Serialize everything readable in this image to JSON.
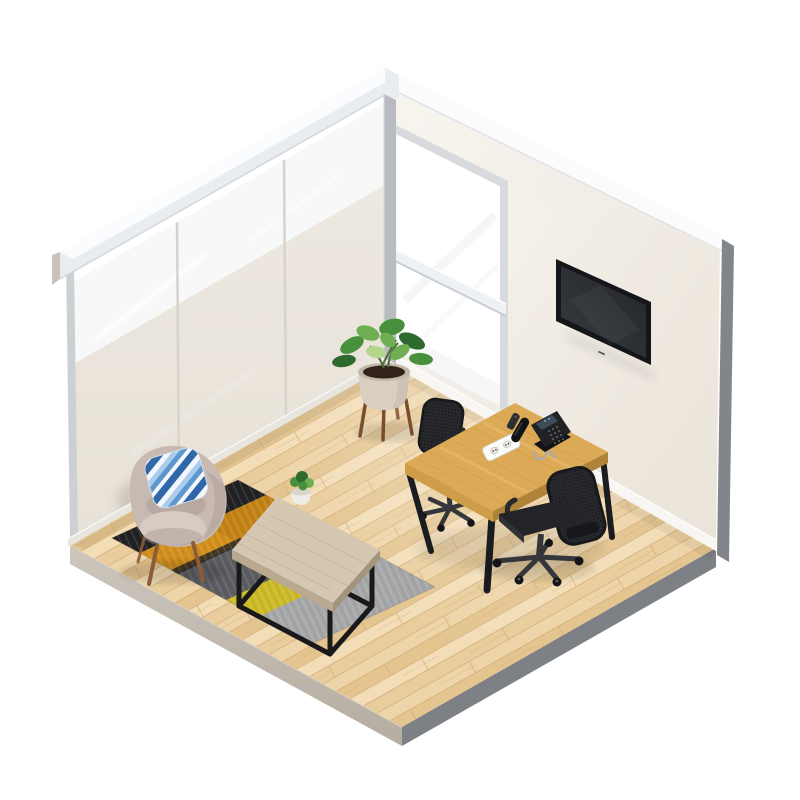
{
  "scene": {
    "title": "Isometric 3D render of a corner office meeting room",
    "objects": [
      {
        "name": "glass-partition-wall",
        "label": "frosted glass partition wall, 3 panels"
      },
      {
        "name": "right-wall",
        "label": "white wall with tall window and wall-mounted TV"
      },
      {
        "name": "window",
        "label": "tall bright window with white crossbar"
      },
      {
        "name": "tv",
        "label": "black flat-screen TV mounted on wall"
      },
      {
        "name": "wood-floor",
        "label": "light oak plank floor slab"
      },
      {
        "name": "desk",
        "label": "oak meeting desk with black splayed legs"
      },
      {
        "name": "desk-phone",
        "label": "black IP desk phone with coiled cord"
      },
      {
        "name": "remote-control",
        "label": "small black remote on desk"
      },
      {
        "name": "power-outlet",
        "label": "white cable outlet module on desk"
      },
      {
        "name": "office-chair-back",
        "label": "black mesh task chair behind desk"
      },
      {
        "name": "office-chair-front",
        "label": "black mesh swivel chair with casters in front of desk"
      },
      {
        "name": "rug",
        "label": "striped rug: black, amber, dark gray, yellow, silver"
      },
      {
        "name": "coffee-table",
        "label": "light wood coffee table with black metal box frame"
      },
      {
        "name": "table-plant",
        "label": "small green plant in white pot on coffee table"
      },
      {
        "name": "armchair",
        "label": "greige wingback lounge armchair with wooden legs"
      },
      {
        "name": "striped-pillow",
        "label": "blue and white striped cushion on armchair"
      },
      {
        "name": "floor-plant",
        "label": "rubber plant in beige pot on wooden stand"
      }
    ]
  },
  "colors": {
    "page_bg": "#ffffff",
    "wall_face_light": "#f8f5f0",
    "wall_face_dark": "#eae3d8",
    "wall_top_band": "#fafbfd",
    "wall_band_edge": "#e0e4e8",
    "wall_side_gray": "#82858a",
    "slab_left_top": "#cdc6bc",
    "slab_left_bottom": "#b5ada2",
    "slab_right": "#7d8085",
    "beam_face": "#e9edf1",
    "beam_top": "#fbfcfe",
    "beam_cap": "#c8c2b8",
    "beam_edge": "#d2d7db",
    "glass_upper": "#f6f8f8",
    "frost_top": "#ede8e0",
    "frost_bottom": "#e7e1d7",
    "frost_shadow": "#8b8175",
    "mullion": "#d6d3cd",
    "edge_post": "#cdd0d3",
    "corner_post": "#b8bbbf",
    "sill": "#e8e5df",
    "window_glass": "#ffffff",
    "window_frame": "#d8dbde",
    "crossbar_face": "#eef1f3",
    "crossbar_shadow": "#c9cdd1",
    "baseboard": "#f7f6f3",
    "plank_a": "#f2ddb6",
    "plank_b": "#e9cd9c",
    "plank_c": "#eed5a9",
    "plank_d": "#e4c590",
    "seam": "#d2aa76",
    "grain_streak": "#c49a63",
    "glow_white": "#ffffff",
    "tv_frame": "#151619",
    "tv_screen_dark": "#232529",
    "tv_screen_light": "#383b40",
    "tv_shadow": "#23242a",
    "desk_top": "#dcaa57",
    "desk_edge_left": "#cf9d48",
    "desk_edge_right": "#b0833a",
    "desk_grain": "#c6963f",
    "desk_grain_light": "#f0cf8e",
    "desk_leg": "#1b1c1f",
    "chair_mesh": "#28292d",
    "chair_mesh_dark": "#17181b",
    "chair_seat": "#232428",
    "chair_seat_edge": "#313236",
    "chair_base": "#35363a",
    "caster": "#141518",
    "caster_hi": "#5a5c60",
    "phone_body": "#202225",
    "phone_dark": "#121316",
    "phone_screen": "#3e4c5a",
    "phone_key": "#585b5f",
    "phone_glint": "#7fd0e0",
    "phone_cord": "#a8aaac",
    "remote_body": "#2c2e31",
    "outlet_face": "#fbfbf9",
    "outlet_border": "#d9d7d2",
    "outlet_slot": "#efede9",
    "outlet_port": "#55534e",
    "rug_black": "#222124",
    "rug_amber": "#d28f1c",
    "rug_amber_dark": "#b87a10",
    "rug_gray_dark": "#5b5d62",
    "rug_silver": "#a6a7a9",
    "rug_yellow": "#ccba28",
    "table_top": "#d5c7b1",
    "table_edge_left": "#b8a98f",
    "table_edge_right": "#a3957d",
    "table_grain": "#bcad95",
    "table_frame": "#19191b",
    "pot_small": "#efece7",
    "pot_small_top": "#d9d5cc",
    "leaf_dark": "#2e6a2e",
    "leaf_mid": "#49903c",
    "leaf_light": "#6fae52",
    "leaf_pale": "#b5d48e",
    "armchair_body": "#c8bab2",
    "armchair_light": "#d7cbc3",
    "armchair_shadow": "#a79a91",
    "armchair_leg": "#8a5c38",
    "pillow_white": "#f3f7fb",
    "pillow_light": "#a9cdea",
    "pillow_mid": "#5e97cd",
    "pillow_dark": "#3067a9",
    "plant_pot": "#d8cfc1",
    "plant_pot_top": "#c1b8aa",
    "plant_soil": "#312319",
    "plant_stand": "#7a4e2d",
    "stem_green": "#4c6b35",
    "ao": "#000000"
  }
}
